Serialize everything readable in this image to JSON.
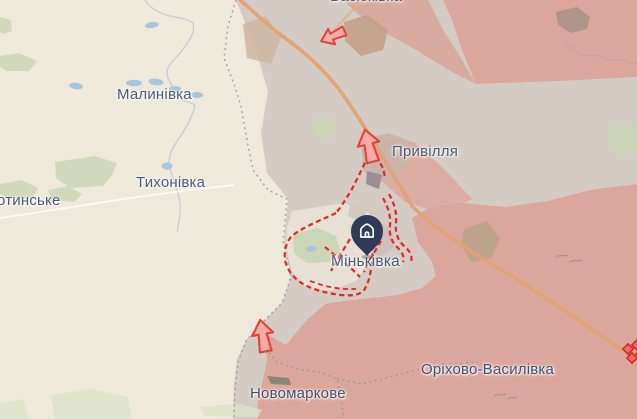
{
  "map": {
    "kind": "frontline-situation-map",
    "towns": [
      {
        "name": "Малинівка"
      },
      {
        "name": "Тихонівка"
      },
      {
        "name": "отинське"
      },
      {
        "name": "Привілля"
      },
      {
        "name": "Міньківка"
      },
      {
        "name": "Оріхово-Василівка"
      },
      {
        "name": "Новомаркове"
      },
      {
        "name": "Васюківка"
      }
    ],
    "marker": {
      "town": "Міньківка",
      "icon": "home-icon"
    },
    "symbols": {
      "advance_arrows": 3,
      "clash_icon": 1,
      "frontline_style": "red-dashed",
      "admin_border_style": "gray-dotted"
    },
    "colors": {
      "base": "#EFE9DC",
      "gray_zone": "#D4CBC4",
      "occupied_zone": "#DBA69C",
      "road": "#E1A272",
      "water": "#A6C6DB",
      "green": "#C9D6B4",
      "frontline_red": "#E8251D",
      "arrow_fill": "#F6ACA4",
      "arrow_stroke": "#E2423A",
      "marker_pin": "#2E3A58",
      "label_text": "#4A5B76"
    }
  }
}
